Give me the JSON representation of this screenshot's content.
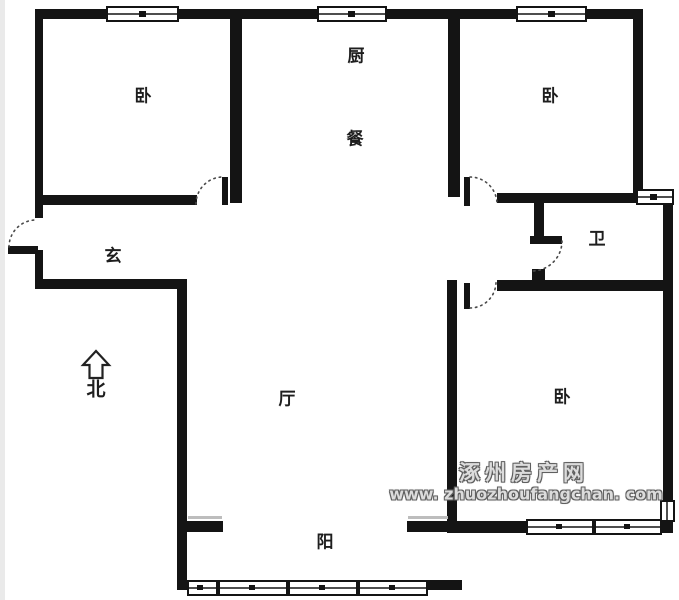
{
  "rooms": [
    {
      "name": "bedroom-northwest",
      "label": "卧"
    },
    {
      "name": "kitchen",
      "label": "厨"
    },
    {
      "name": "dining",
      "label": "餐"
    },
    {
      "name": "bedroom-northeast",
      "label": "卧"
    },
    {
      "name": "foyer",
      "label": "玄"
    },
    {
      "name": "bathroom",
      "label": "卫"
    },
    {
      "name": "living-room",
      "label": "厅"
    },
    {
      "name": "bedroom-southeast",
      "label": "卧"
    },
    {
      "name": "balcony",
      "label": "阳"
    }
  ],
  "compass": {
    "label": "北",
    "icon": "north-arrow-icon"
  },
  "watermark": {
    "site_name": "涿州房产网",
    "site_url": "www. zhuozhoufangchan. com",
    "text_fill": "#dcdcdc",
    "text_outline": "#5f5f5f"
  },
  "colors": {
    "wall": "#141414",
    "background": "#ffffff",
    "door_arc": "#4a4a4a",
    "window_fill": "#ffffff",
    "sill_line": "#bdbdbd"
  }
}
